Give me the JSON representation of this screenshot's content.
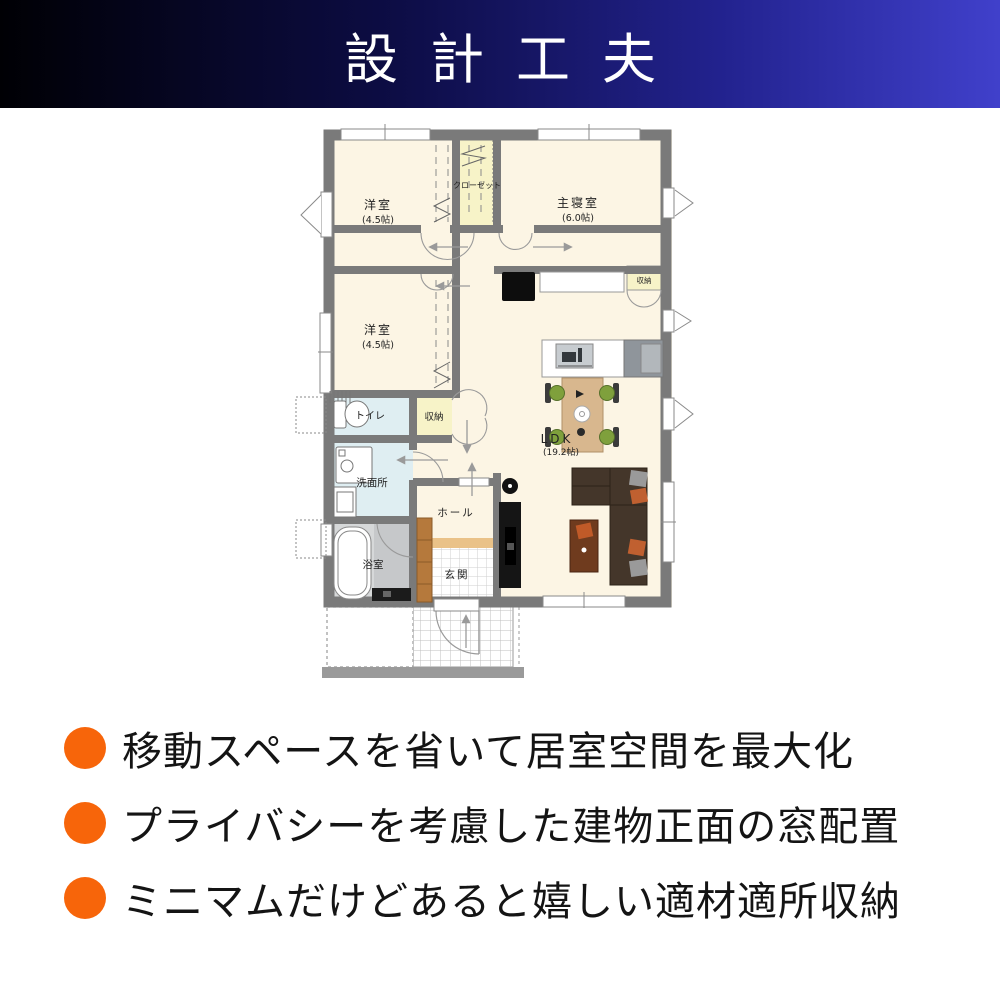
{
  "header": {
    "title": "設計工夫"
  },
  "plan": {
    "rooms": {
      "bedroom1": {
        "name": "洋室",
        "size": "(4.5帖)"
      },
      "closet": {
        "name": "クローゼット"
      },
      "master": {
        "name": "主寝室",
        "size": "(6.0帖)"
      },
      "bedroom2": {
        "name": "洋室",
        "size": "(4.5帖)"
      },
      "toilet": {
        "name": "トイレ"
      },
      "storage_hall": {
        "name": "収納"
      },
      "washroom": {
        "name": "洗面所"
      },
      "bathroom": {
        "name": "浴室"
      },
      "hall": {
        "name": "ホール"
      },
      "entrance": {
        "name": "玄関"
      },
      "ldk": {
        "name": "LDK",
        "size": "(19.2帖)"
      },
      "storage_ldk": {
        "name": "収納"
      }
    }
  },
  "features": [
    {
      "text": "移動スペースを省いて居室空間を最大化"
    },
    {
      "text": "プライバシーを考慮した建物正面の窓配置"
    },
    {
      "text": "ミニマムだけどあると嬉しい適材適所収納"
    }
  ],
  "colors": {
    "header_gradient_left": "#000004",
    "header_gradient_right": "#4040cb",
    "bullet_orange": "#f7650a",
    "wall_gray": "#7a7a7a",
    "floor_cream": "#fcf5e4",
    "closet_yellow": "#f7f3c8",
    "wet_area_blue": "#dfeef2"
  }
}
